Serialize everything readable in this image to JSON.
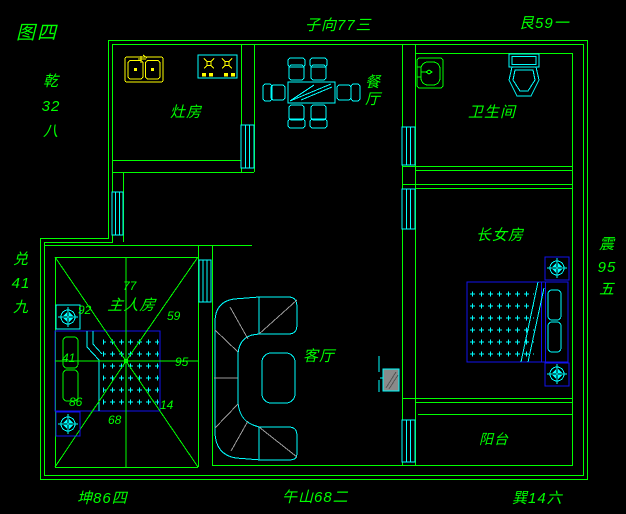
{
  "figure": {
    "title": "图四"
  },
  "colors": {
    "background": "#000000",
    "wall_green": "#00ff00",
    "detail_cyan": "#00ffff",
    "fixture_yellow": "#ffff00",
    "bed_blue": "#1212ee",
    "sofa_gray": "#9a9a9a"
  },
  "compass": {
    "qian_stack": "乾\n32\n八",
    "zi_direction": "子向77三",
    "gen": "艮59一",
    "dui_stack": "兑\n41\n九",
    "zhen_stack": "震\n95\n五",
    "kun": "坤86四",
    "wu_mountain": "午山68二",
    "xun": "巽14六"
  },
  "rooms": {
    "kitchen": "灶房",
    "dining": "餐厅",
    "bathroom": "卫生间",
    "eldest_daughter": "长女房",
    "master_bedroom": "主人房",
    "living_room": "客厅",
    "balcony": "阳台"
  },
  "master_star_numbers": {
    "n92": "92",
    "n77": "77",
    "n59": "59",
    "n41": "41",
    "n95": "95",
    "n86": "86",
    "n68": "68",
    "n14": "14"
  }
}
